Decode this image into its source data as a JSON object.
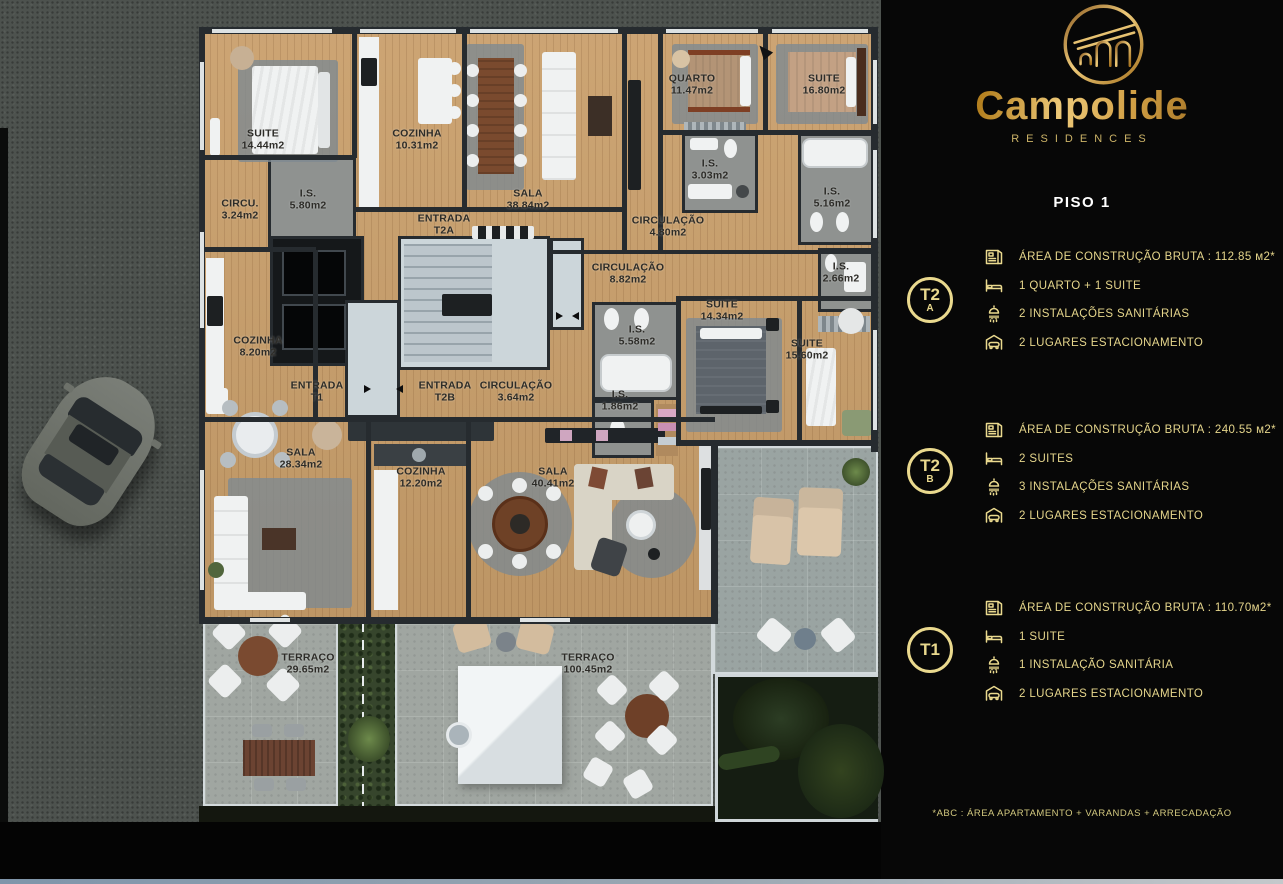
{
  "brand": {
    "name": "Campolide",
    "subtitle": "RESIDENCES"
  },
  "page_title": "PISO 1",
  "units": [
    {
      "badge_line1": "T2",
      "badge_line2": "A",
      "specs": [
        {
          "icon": "area-icon",
          "text": "ÁREA DE CONSTRUÇÃO BRUTA :  112.85 м2*"
        },
        {
          "icon": "bed-icon",
          "text": "1 QUARTO + 1 SUITE"
        },
        {
          "icon": "shower-icon",
          "text": "2 INSTALAÇÕES SANITÁRIAS"
        },
        {
          "icon": "parking-icon",
          "text": "2 LUGARES ESTACIONAMENTO"
        }
      ]
    },
    {
      "badge_line1": "T2",
      "badge_line2": "B",
      "specs": [
        {
          "icon": "area-icon",
          "text": "ÁREA DE CONSTRUÇÃO BRUTA :  240.55 м2*"
        },
        {
          "icon": "bed-icon",
          "text": "2 SUITES"
        },
        {
          "icon": "shower-icon",
          "text": "3 INSTALAÇÕES SANITÁRIAS"
        },
        {
          "icon": "parking-icon",
          "text": "2 LUGARES ESTACIONAMENTO"
        }
      ]
    },
    {
      "badge_line1": "T1",
      "badge_line2": "",
      "specs": [
        {
          "icon": "area-icon",
          "text": "ÁREA DE CONSTRUÇÃO BRUTA :  110.70м2*"
        },
        {
          "icon": "bed-icon",
          "text": "1 SUITE"
        },
        {
          "icon": "shower-icon",
          "text": "1 INSTALAÇÃO SANITÁRIA"
        },
        {
          "icon": "parking-icon",
          "text": "2 LUGARES ESTACIONAMENTO"
        }
      ]
    }
  ],
  "footnote": "*ABC :  ÁREA APARTAMENTO + VARANDAS + ARRECADAÇÃO",
  "colors": {
    "accent_gold": "#ead98e",
    "panel_bg": "#070707",
    "wood_floor": "#c99f6b",
    "terrace_tile": "#a0a6a1",
    "asphalt": "#4d524e"
  },
  "plan": {
    "floor": "PISO 1",
    "rooms": [
      {
        "name": "SUITE",
        "area": "14.44m2",
        "x": 263,
        "y": 140
      },
      {
        "name": "COZINHA",
        "area": "10.31m2",
        "x": 417,
        "y": 140
      },
      {
        "name": "SALA",
        "area": "38.84m2",
        "x": 528,
        "y": 200
      },
      {
        "name": "QUARTO",
        "area": "11.47m2",
        "x": 692,
        "y": 85
      },
      {
        "name": "SUITE",
        "area": "16.80m2",
        "x": 824,
        "y": 85
      },
      {
        "name": "I.S.",
        "area": "3.03m2",
        "x": 710,
        "y": 170
      },
      {
        "name": "CIRCULAÇÃO",
        "area": "4.80m2",
        "x": 668,
        "y": 227
      },
      {
        "name": "I.S.",
        "area": "5.16m2",
        "x": 832,
        "y": 198
      },
      {
        "name": "CIRCU.",
        "area": "3.24m2",
        "x": 240,
        "y": 210
      },
      {
        "name": "I.S.",
        "area": "5.80m2",
        "x": 308,
        "y": 200
      },
      {
        "name": "ENTRADA",
        "area": "T2A",
        "x": 444,
        "y": 225
      },
      {
        "name": "CIRCULAÇÃO",
        "area": "8.82m2",
        "x": 628,
        "y": 274
      },
      {
        "name": "I.S.",
        "area": "2.66m2",
        "x": 841,
        "y": 273
      },
      {
        "name": "SUITE",
        "area": "14.34m2",
        "x": 722,
        "y": 311
      },
      {
        "name": "I.S.",
        "area": "5.58m2",
        "x": 637,
        "y": 336
      },
      {
        "name": "SUITE",
        "area": "15.60m2",
        "x": 807,
        "y": 350
      },
      {
        "name": "I.S.",
        "area": "1.86m2",
        "x": 620,
        "y": 401
      },
      {
        "name": "COZINHA",
        "area": "8.20m2",
        "x": 258,
        "y": 347
      },
      {
        "name": "ENTRADA",
        "area": "T1",
        "x": 317,
        "y": 392
      },
      {
        "name": "ENTRADA",
        "area": "T2B",
        "x": 445,
        "y": 392
      },
      {
        "name": "CIRCULAÇÃO",
        "area": "3.64m2",
        "x": 516,
        "y": 392
      },
      {
        "name": "SALA",
        "area": "28.34m2",
        "x": 301,
        "y": 459
      },
      {
        "name": "COZINHA",
        "area": "12.20m2",
        "x": 421,
        "y": 478
      },
      {
        "name": "SALA",
        "area": "40.41m2",
        "x": 553,
        "y": 478
      },
      {
        "name": "TERRAÇO",
        "area": "29.65m2",
        "x": 308,
        "y": 664
      },
      {
        "name": "TERRAÇO",
        "area": "100.45m2",
        "x": 588,
        "y": 664
      }
    ]
  }
}
